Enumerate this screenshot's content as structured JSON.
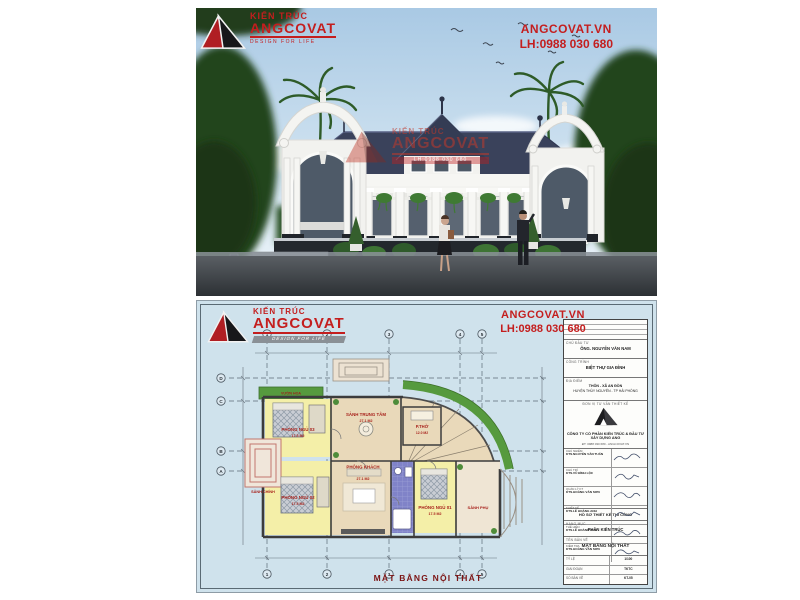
{
  "brand": {
    "type_label": "KIẾN TRÚC",
    "name": "ANGCOVAT",
    "tagline": "DESIGN FOR LIFE",
    "website": "ANGCOVAT.VN",
    "hotline": "LH:0988 030 680",
    "accent_red": "#c41e1e"
  },
  "plan": {
    "caption": "MẶT BẰNG NỘI THẤT",
    "garden_label": "VƯỜN HOA",
    "grid": {
      "cols": [
        "1",
        "2",
        "3",
        "4",
        "5"
      ],
      "rows": [
        "A",
        "B",
        "C",
        "D"
      ]
    },
    "rooms": {
      "bedroom3": {
        "name": "PHÒNG NGỦ 03",
        "area": "17.5 M2"
      },
      "hall": {
        "name": "SẢNH TRUNG TÂM",
        "area": "27.1 M2"
      },
      "worship": {
        "name": "P.THỜ",
        "area": "12.0 M2"
      },
      "bedroom2": {
        "name": "PHÒNG NGỦ 02",
        "area": "17.5 M2"
      },
      "living": {
        "name": "PHÒNG KHÁCH",
        "area": "27.1 M2"
      },
      "wc": {
        "name": "WC",
        "area": "6.0 M2"
      },
      "bedroom1": {
        "name": "PHÒNG NGỦ 01",
        "area": "17.5 M2"
      },
      "side_porch": {
        "name": "SẢNH PHỤ"
      },
      "main_porch": {
        "name": "SẢNH CHÍNH"
      }
    },
    "titleblock": {
      "owner_label": "CHỦ ĐẦU TƯ",
      "owner": "ÔNG. NGUYỄN VĂN NAM",
      "project_label": "CÔNG TRÌNH",
      "project": "BIỆT THỰ GIA ĐÌNH",
      "location_label": "ĐỊA ĐIỂM",
      "location_line1": "THÔN - XÃ AN ĐỒN",
      "location_line2": "HUYỆN THỦY NGUYÊN - TP HẢI PHÒNG",
      "consultant_label": "ĐƠN VỊ TƯ VẤN THIẾT KẾ",
      "company": "CÔNG TY CỔ PHẦN KIẾN TRÚC & ĐẦU TƯ XÂY DỰNG ANG",
      "company_contact": "ĐT: 0988 030 680 - ANGCOVAT.VN",
      "signatures": [
        {
          "role": "CHỦ NHIỆM",
          "name": "KTS.NGUYỄN VĂN TUẤN"
        },
        {
          "role": "CHỦ TRÌ",
          "name": "KTS.VŨ ĐÌNH LỘC"
        },
        {
          "role": "QUẢN LÝ KT",
          "name": "KTS.HOÀNG VĂN SƠN"
        },
        {
          "role": "THIẾT KẾ",
          "name": "KTS.LÊ HOÀNG ANH"
        },
        {
          "role": "THỂ HIỆN",
          "name": "KTS.LÊ HOÀNG ANH"
        },
        {
          "role": "KIỂM TRA",
          "name": "KTS.HOÀNG VĂN SƠN"
        }
      ],
      "dossier": "HỒ SƠ THIẾT KẾ THI CÔNG",
      "part_label": "HẠNG MỤC",
      "part": "PHẦN KIẾN TRÚC",
      "drawing_label": "TÊN BẢN VẼ",
      "drawing_name": "MẶT BẰNG NỘI THẤT",
      "scale_label": "TỶ LỆ",
      "scale": "1/100",
      "stage_label": "GIAI ĐOẠN",
      "stage": "TKTC",
      "sheet_label": "SỐ BẢN VẼ",
      "sheet": "KT-05"
    }
  }
}
